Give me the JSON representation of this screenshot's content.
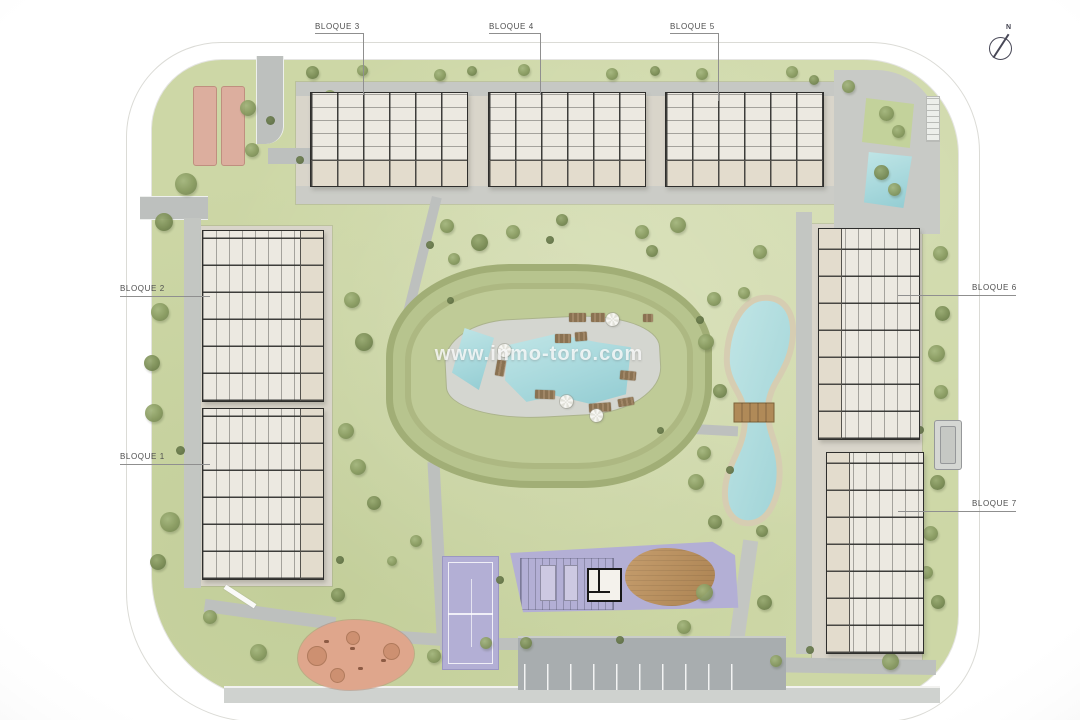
{
  "plan": {
    "watermark": "www.inmo-toro.com",
    "compass": {
      "label": "N"
    },
    "blocks": [
      {
        "label": "BLOQUE 1"
      },
      {
        "label": "BLOQUE 2"
      },
      {
        "label": "BLOQUE 3"
      },
      {
        "label": "BLOQUE 4"
      },
      {
        "label": "BLOQUE 5"
      },
      {
        "label": "BLOQUE 6"
      },
      {
        "label": "BLOQUE 7"
      }
    ]
  },
  "colors": {
    "parcel": "#cdd7a6",
    "mound": "#b7c48e",
    "path": "#bdc0be",
    "plaza": "#d9d5ca",
    "building": "#ece9e1",
    "wall": "#2e2e2c",
    "water": "#a7d8dc",
    "lakeSand": "#d6cdb2",
    "purple": "#b3afd5",
    "salmon": "#dcae9e",
    "playground": "#dfa68c",
    "parking": "#a8adaf",
    "brown": "#b98a5e",
    "tree": "#87995f",
    "label": "#4e4e4e"
  }
}
